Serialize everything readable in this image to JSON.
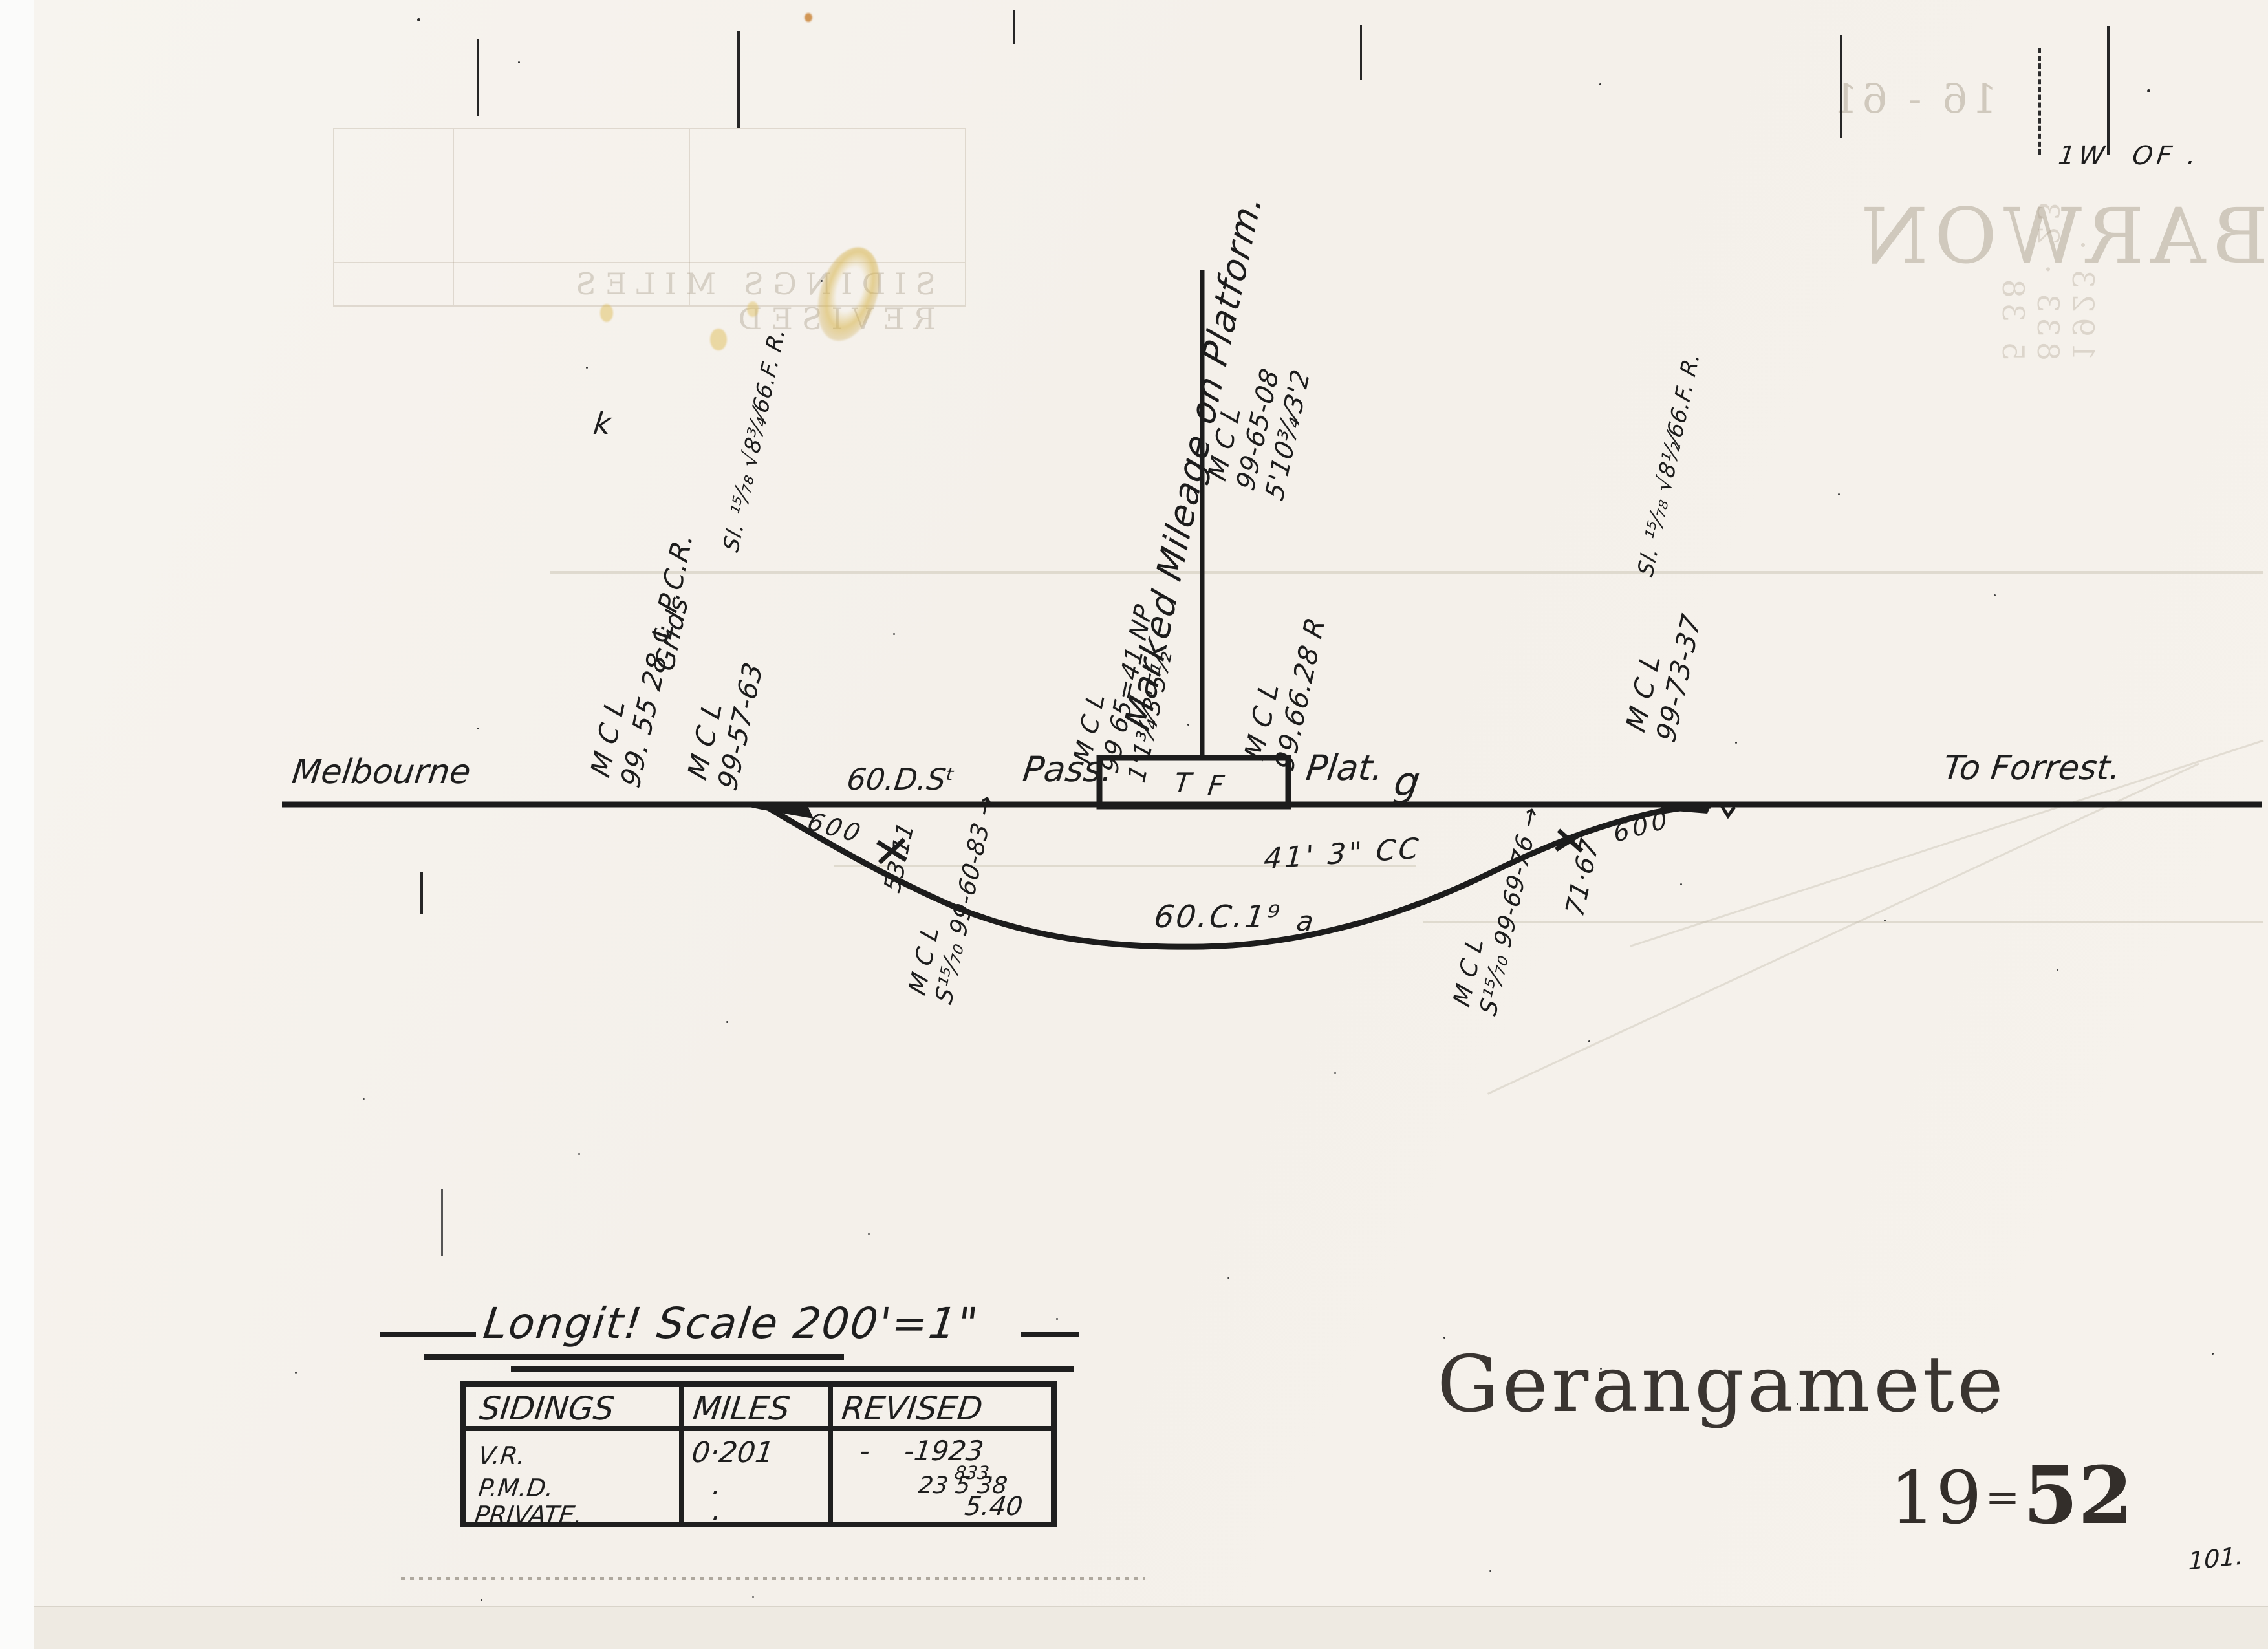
{
  "sheet": {
    "station_name": "Gerangamete",
    "number_prefix": "19",
    "number_separator": "=",
    "number_suffix": "52",
    "corner_note": "1W  OF .",
    "page_number": "101.",
    "stray_mark": "k"
  },
  "line": {
    "from": "Melbourne",
    "to": "To Forrest.",
    "main_rail": "60.D.Sᵗ",
    "loop_rail": "60.C.1⁹",
    "loop_letter": "a",
    "platform_label_left": "Pass.",
    "platform_label_right": "Plat.",
    "platform_mark": "g",
    "platform_t": "T",
    "platform_f": "F",
    "clearance": "41' 3\" CC",
    "radius_left": "600",
    "radius_right": "600"
  },
  "annotations": [
    {
      "text": "M  C  L\n99. 55 28 ℄ P.C.R."
    },
    {
      "text": "Grids"
    },
    {
      "text": "Sl. ¹⁵⁄₇₈ √8¾⁄66.F. R."
    },
    {
      "text": "M C L\n99-57-63"
    },
    {
      "text": "M C L\nS¹⁵⁄₇₀ 99-60-83 →"
    },
    {
      "text": "71·67"
    },
    {
      "text": "53·11"
    },
    {
      "text": "M C L\nS¹⁵⁄₇₀ 99-69-76 →"
    },
    {
      "text": "Sl. ¹⁵⁄₇₈ √8½⁄66.F. R."
    },
    {
      "text": "M C L\n99-73-37"
    },
    {
      "text": "M C L\n99-65-08\n5'10¾⁄3'2"
    },
    {
      "text": "M C L\n99.66.28 R"
    },
    {
      "text": "M C L\n99 65=41 NP\n1'1¾⁄3'5½"
    },
    {
      "text": "Marked Mileage on Platform."
    }
  ],
  "scale": {
    "title": "Longit! Scale 200'=1\""
  },
  "table": {
    "headers": [
      "SIDINGS",
      "MILES",
      "REVISED"
    ],
    "rows": [
      {
        "siding": "V.R.",
        "miles": "0·201",
        "revised": "-    -1923"
      },
      {
        "siding": "P.M.D.",
        "miles": "·",
        "revised": "23 5 38"
      },
      {
        "siding": "PRIVATE.",
        "miles": "·",
        "revised": "5.40"
      }
    ],
    "revised_note": "833."
  },
  "bleed": {
    "station_mirrored": "BARWON",
    "number_mirrored": "16 - 61",
    "table_mirrored": "SIDINGS   MILES   REVISED",
    "column_mirrored": "1923 · 833 · 23 5 38"
  }
}
